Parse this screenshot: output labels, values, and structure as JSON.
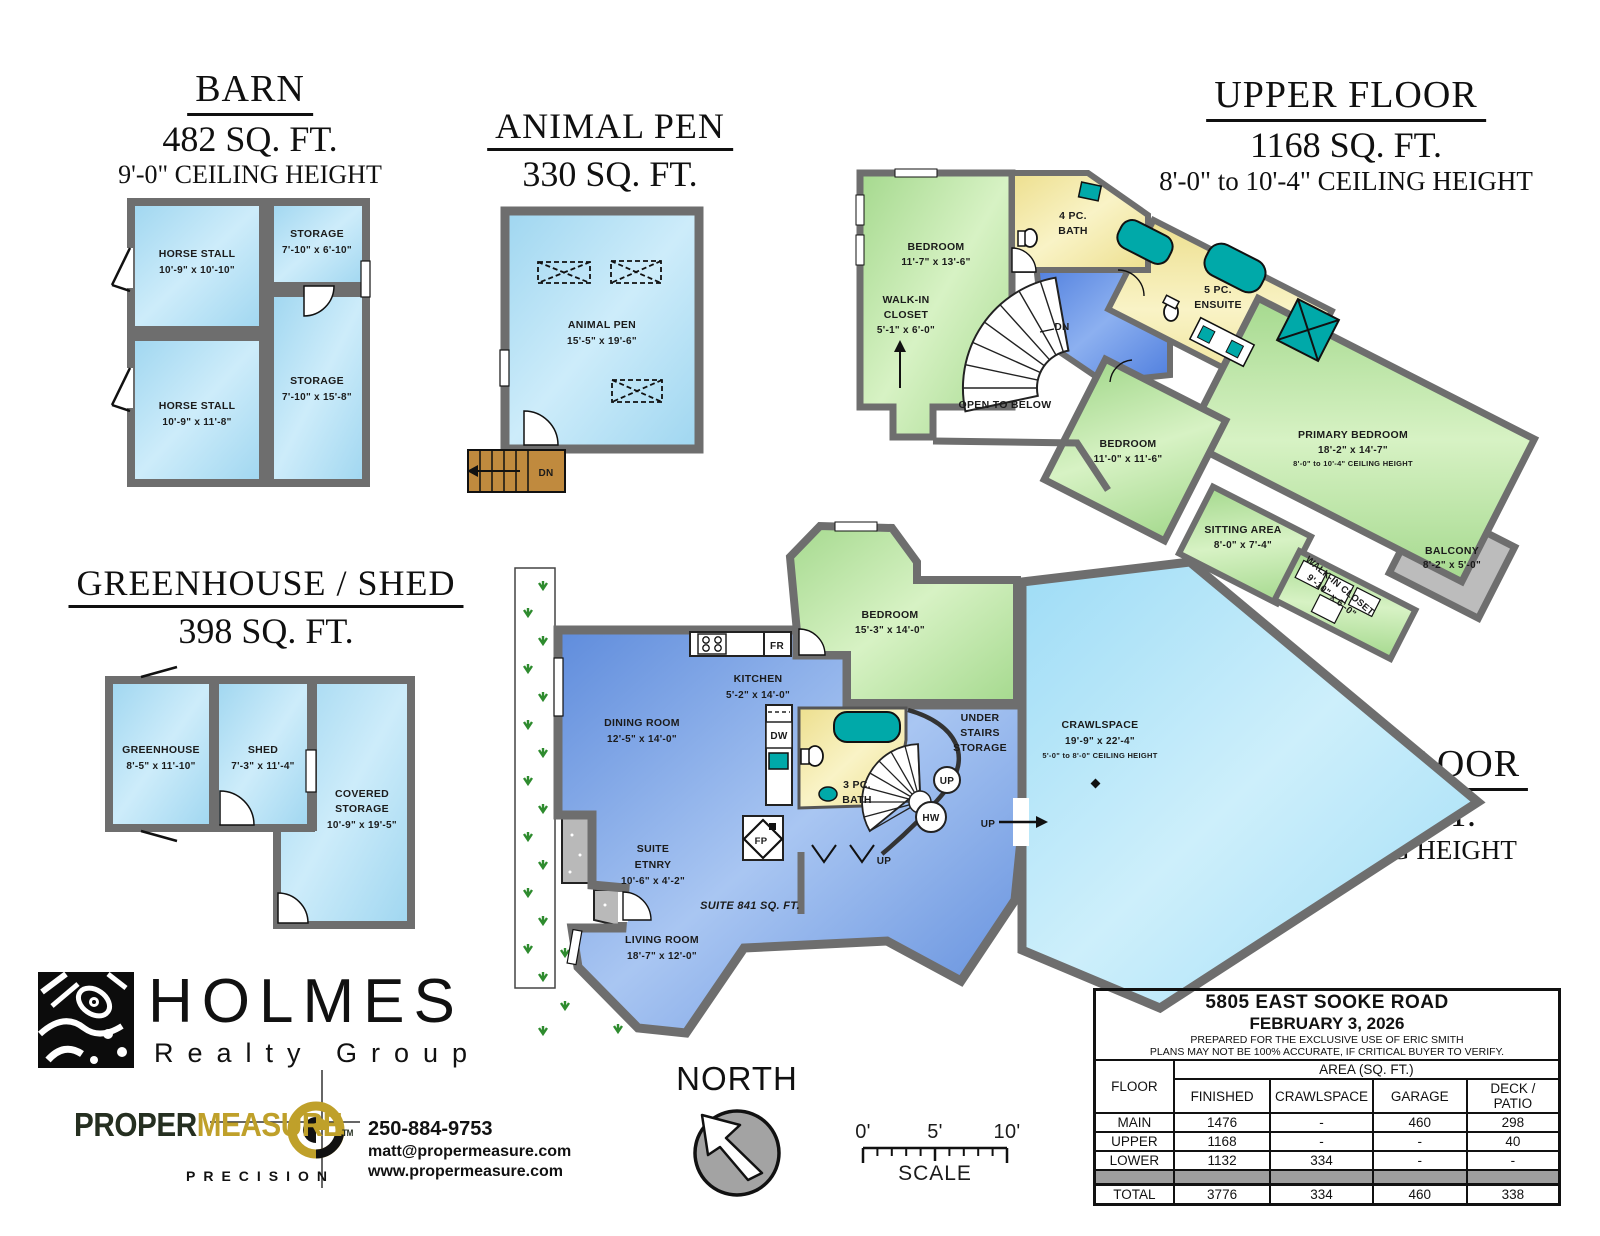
{
  "barn": {
    "title": "BARN",
    "area": "482 SQ. FT.",
    "ceiling": "9'-0\" CEILING HEIGHT",
    "rooms": [
      {
        "name": "HORSE STALL",
        "dims": "10'-9\" x 10'-10\""
      },
      {
        "name": "STORAGE",
        "dims": "7'-10\" x 6'-10\""
      },
      {
        "name": "HORSE STALL",
        "dims": "10'-9\" x 11'-8\""
      },
      {
        "name": "STORAGE",
        "dims": "7'-10\" x 15'-8\""
      }
    ]
  },
  "animal_pen": {
    "title": "ANIMAL PEN",
    "area": "330 SQ. FT.",
    "room": {
      "name": "ANIMAL PEN",
      "dims": "15'-5\" x 19'-6\""
    },
    "dn": "DN"
  },
  "upper_floor": {
    "title": "UPPER FLOOR",
    "area": "1168 SQ. FT.",
    "ceiling": "8'-0\" to 10'-4\" CEILING HEIGHT",
    "rooms": {
      "bedroom1": {
        "name": "BEDROOM",
        "dims": "11'-7\" x 13'-6\""
      },
      "walkin1": {
        "l1": "WALK-IN",
        "l2": "CLOSET",
        "dims": "5'-1\" x 6'-0\""
      },
      "bath": {
        "l1": "4 PC.",
        "l2": "BATH"
      },
      "ensuite": {
        "l1": "5 PC.",
        "l2": "ENSUITE"
      },
      "open_below": "OPEN TO BELOW",
      "dn": "DN",
      "bedroom2": {
        "name": "BEDROOM",
        "dims": "11'-0\" x 11'-6\""
      },
      "primary": {
        "name": "PRIMARY BEDROOM",
        "dims": "18'-2\" x 14'-7\"",
        "ceiling": "8'-0\" to 10'-4\" CEILING HEIGHT"
      },
      "sitting": {
        "name": "SITTING AREA",
        "dims": "8'-0\" x 7'-4\""
      },
      "walkin2": {
        "name": "WALK-IN CLOSET",
        "dims": "9'-10\" x 6'-0\""
      },
      "balcony": {
        "name": "BALCONY",
        "dims": "8'-2\" x 5'-0\""
      }
    }
  },
  "greenhouse_shed": {
    "title": "GREENHOUSE / SHED",
    "area": "398 SQ. FT.",
    "rooms": {
      "greenhouse": {
        "name": "GREENHOUSE",
        "dims": "8'-5\" x 11'-10\""
      },
      "shed": {
        "name": "SHED",
        "dims": "7'-3\" x 11'-4\""
      },
      "covered": {
        "l1": "COVERED",
        "l2": "STORAGE",
        "dims": "10'-9\" x 19'-5\""
      }
    }
  },
  "lower_floor": {
    "title": "LOWER FLOOR",
    "area": "1132 SQ. FT.",
    "ceiling": "8'-0\" CEILING HEIGHT",
    "suite_label": "SUITE 841 SQ. FT.",
    "rooms": {
      "bedroom": {
        "name": "BEDROOM",
        "dims": "15'-3\" x 14'-0\""
      },
      "kitchen": {
        "name": "KITCHEN",
        "dims": "5'-2\" x 14'-0\""
      },
      "dining": {
        "name": "DINING ROOM",
        "dims": "12'-5\" x 14'-0\""
      },
      "bath": {
        "l1": "3 PC.",
        "l2": "BATH"
      },
      "under_stairs": {
        "l1": "UNDER",
        "l2": "STAIRS",
        "l3": "STORAGE"
      },
      "crawlspace": {
        "name": "CRAWLSPACE",
        "dims": "19'-9\" x 22'-4\"",
        "ceiling": "5'-0\" to 8'-0\" CEILING HEIGHT"
      },
      "entry": {
        "l1": "SUITE",
        "l2": "ETNRY",
        "dims": "10'-6\" x 4'-2\""
      },
      "living": {
        "name": "LIVING ROOM",
        "dims": "18'-7\" x 12'-0\""
      }
    },
    "labels": {
      "fr": "FR",
      "dw": "DW",
      "fp": "FP",
      "hw": "HW",
      "up": "UP"
    }
  },
  "branding": {
    "holmes": "HOLMES",
    "realty": "Realty Group",
    "proper": "PROPER",
    "measure": "MEASURE",
    "tm": "TM",
    "precision": "PRECISION",
    "phone": "250-884-9753",
    "email": "matt@propermeasure.com",
    "website": "www.propermeasure.com"
  },
  "compass": {
    "label": "NORTH"
  },
  "scale_bar": {
    "t0": "0'",
    "t5": "5'",
    "t10": "10'",
    "label": "SCALE"
  },
  "info_table": {
    "address": "5805 EAST SOOKE ROAD",
    "date": "FEBRUARY 3, 2026",
    "prepared": "PREPARED FOR THE EXCLUSIVE USE OF ERIC SMITH",
    "disclaimer": "PLANS MAY NOT BE 100% ACCURATE, IF CRITICAL BUYER TO VERIFY.",
    "floor_header": "FLOOR",
    "area_header": "AREA (SQ. FT.)",
    "col_headers": [
      "FINISHED",
      "CRAWLSPACE",
      "GARAGE",
      "DECK / PATIO"
    ],
    "rows": [
      {
        "floor": "MAIN",
        "finished": "1476",
        "crawlspace": "-",
        "garage": "460",
        "deck": "298"
      },
      {
        "floor": "UPPER",
        "finished": "1168",
        "crawlspace": "-",
        "garage": "-",
        "deck": "40"
      },
      {
        "floor": "LOWER",
        "finished": "1132",
        "crawlspace": "334",
        "garage": "-",
        "deck": "-"
      }
    ],
    "total_row": {
      "floor": "TOTAL",
      "finished": "3776",
      "crawlspace": "334",
      "garage": "460",
      "deck": "338"
    }
  },
  "colors": {
    "room_light_blue": "#aadcf4",
    "room_green": "#b2e29c",
    "room_yellow": "#f2e7a4",
    "suite_blue": "#84abe8",
    "hall_blue": "#6b93e6",
    "crawl_cyan": "#aee4f8",
    "wall_gray": "#6e6e6e",
    "fixture_teal": "#00a9a9",
    "stair_brown": "#c08a3e",
    "balcony_gray": "#bcbcbc",
    "brand_gold": "#bfa02a",
    "landscape_green": "#2e8b2e"
  }
}
